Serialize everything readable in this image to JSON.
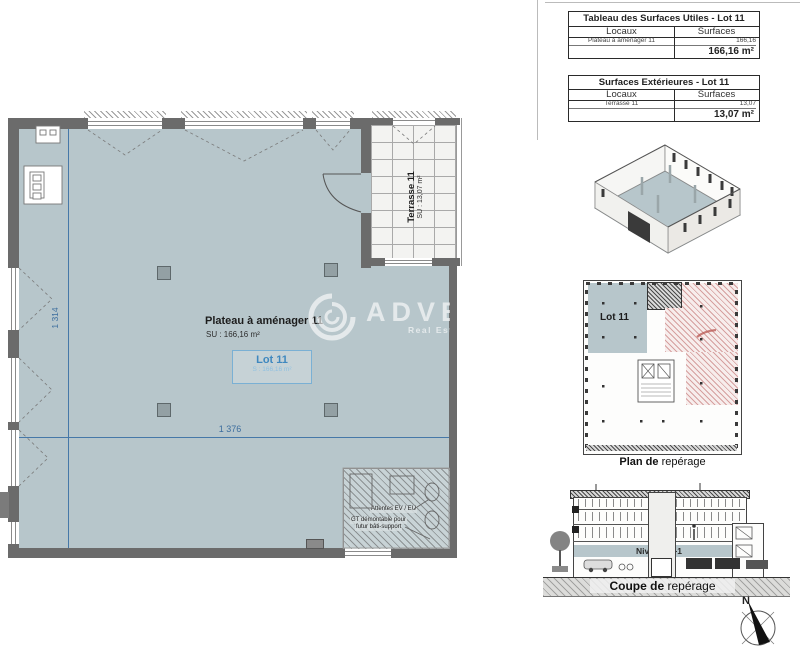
{
  "tables": {
    "surfaces_utiles": {
      "title": "Tableau des Surfaces Utiles - Lot 11",
      "col_locaux": "Locaux",
      "col_surfaces": "Surfaces",
      "row_label": "Plateau à aménager 11",
      "row_value": "166,16",
      "total": "166,16 m²"
    },
    "surfaces_exterieures": {
      "title": "Surfaces Extérieures - Lot 11",
      "col_locaux": "Locaux",
      "col_surfaces": "Surfaces",
      "row_label": "Terrasse 11",
      "row_value": "13,07",
      "total": "13,07 m²"
    }
  },
  "floor_plan": {
    "room_title": "Plateau à aménager 11",
    "room_su": "SU : 166,16 m²",
    "lot_title": "Lot 11",
    "lot_surface": "S : 166,16 m²",
    "terrace_title": "Terrasse 11",
    "terrace_su": "SU : 13,07 m²",
    "dim_vertical": "1 314",
    "dim_horizontal": "1 376",
    "note_attentes": "Attentes EV / EU",
    "note_gt_line1": "GT démontable pour",
    "note_gt_line2": "futur bâti-support"
  },
  "watermark": {
    "brand": "ADVENIS",
    "tagline": "Real Estate Solutions"
  },
  "location_plan": {
    "lot_label": "Lot 11",
    "caption_bold": "Plan de",
    "caption_regular": " repérage"
  },
  "section_view": {
    "level_label": "Niveau R+1",
    "caption_bold": "Coupe de",
    "caption_regular": " repérage"
  },
  "compass": {
    "north": "N"
  },
  "colors": {
    "floor": "#b7c6cb",
    "wall": "#6b6b6b",
    "dimension_blue": "#4678a8",
    "lot_blue": "#3f88bf",
    "red_hatch": "#ba6060"
  }
}
